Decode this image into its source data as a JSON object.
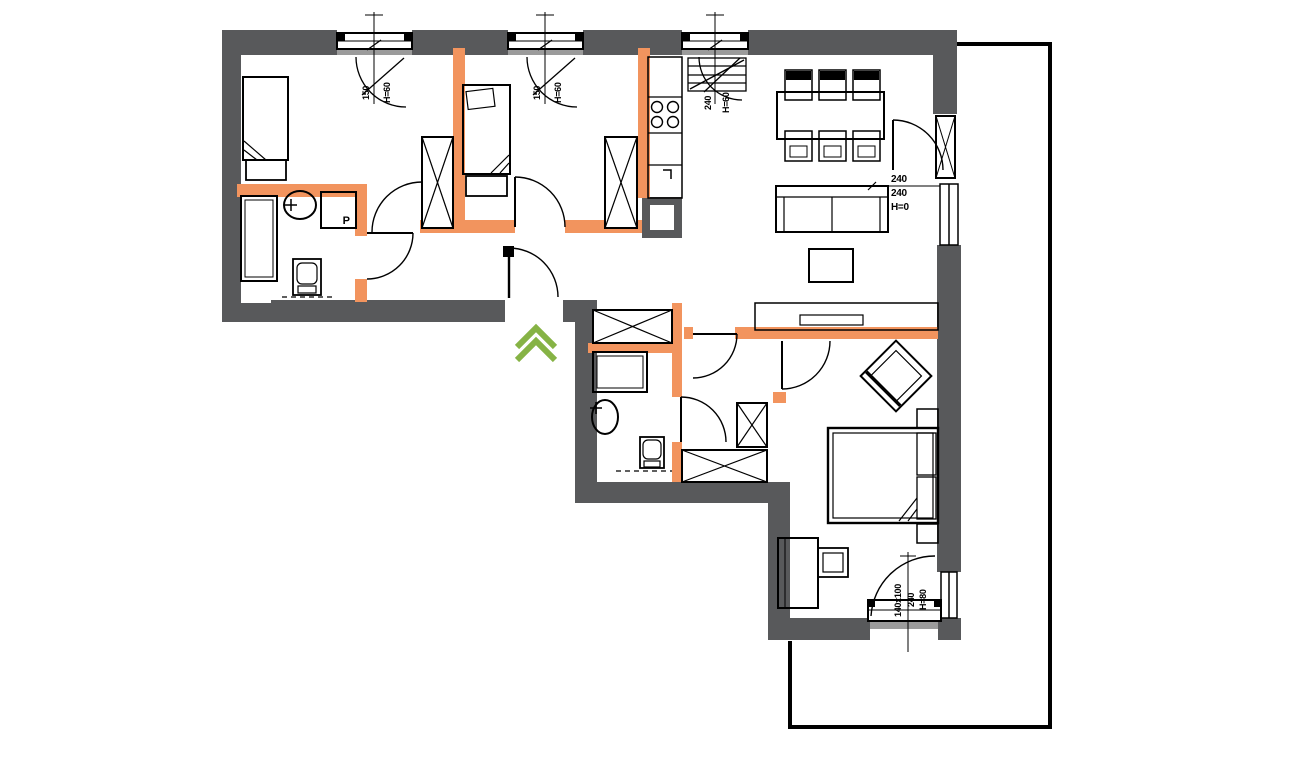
{
  "annotations": {
    "window_a": [
      "150",
      "H=60"
    ],
    "window_b": [
      "150",
      "H=60"
    ],
    "window_kitchen": [
      "240",
      "H=60"
    ],
    "balcony_door": [
      "240",
      "240",
      "H=0"
    ],
    "bedroom_window": [
      "140x100",
      "240",
      "H=80"
    ],
    "washer_label": "P"
  },
  "colors": {
    "exterior_wall": "#58595B",
    "partition_wall": "#F2945E",
    "window_sill": "#9B9B9B",
    "entrance_arrow": "#86B345",
    "line": "#000000"
  },
  "icons": {
    "entrance_arrow": "double-chevron-up"
  }
}
